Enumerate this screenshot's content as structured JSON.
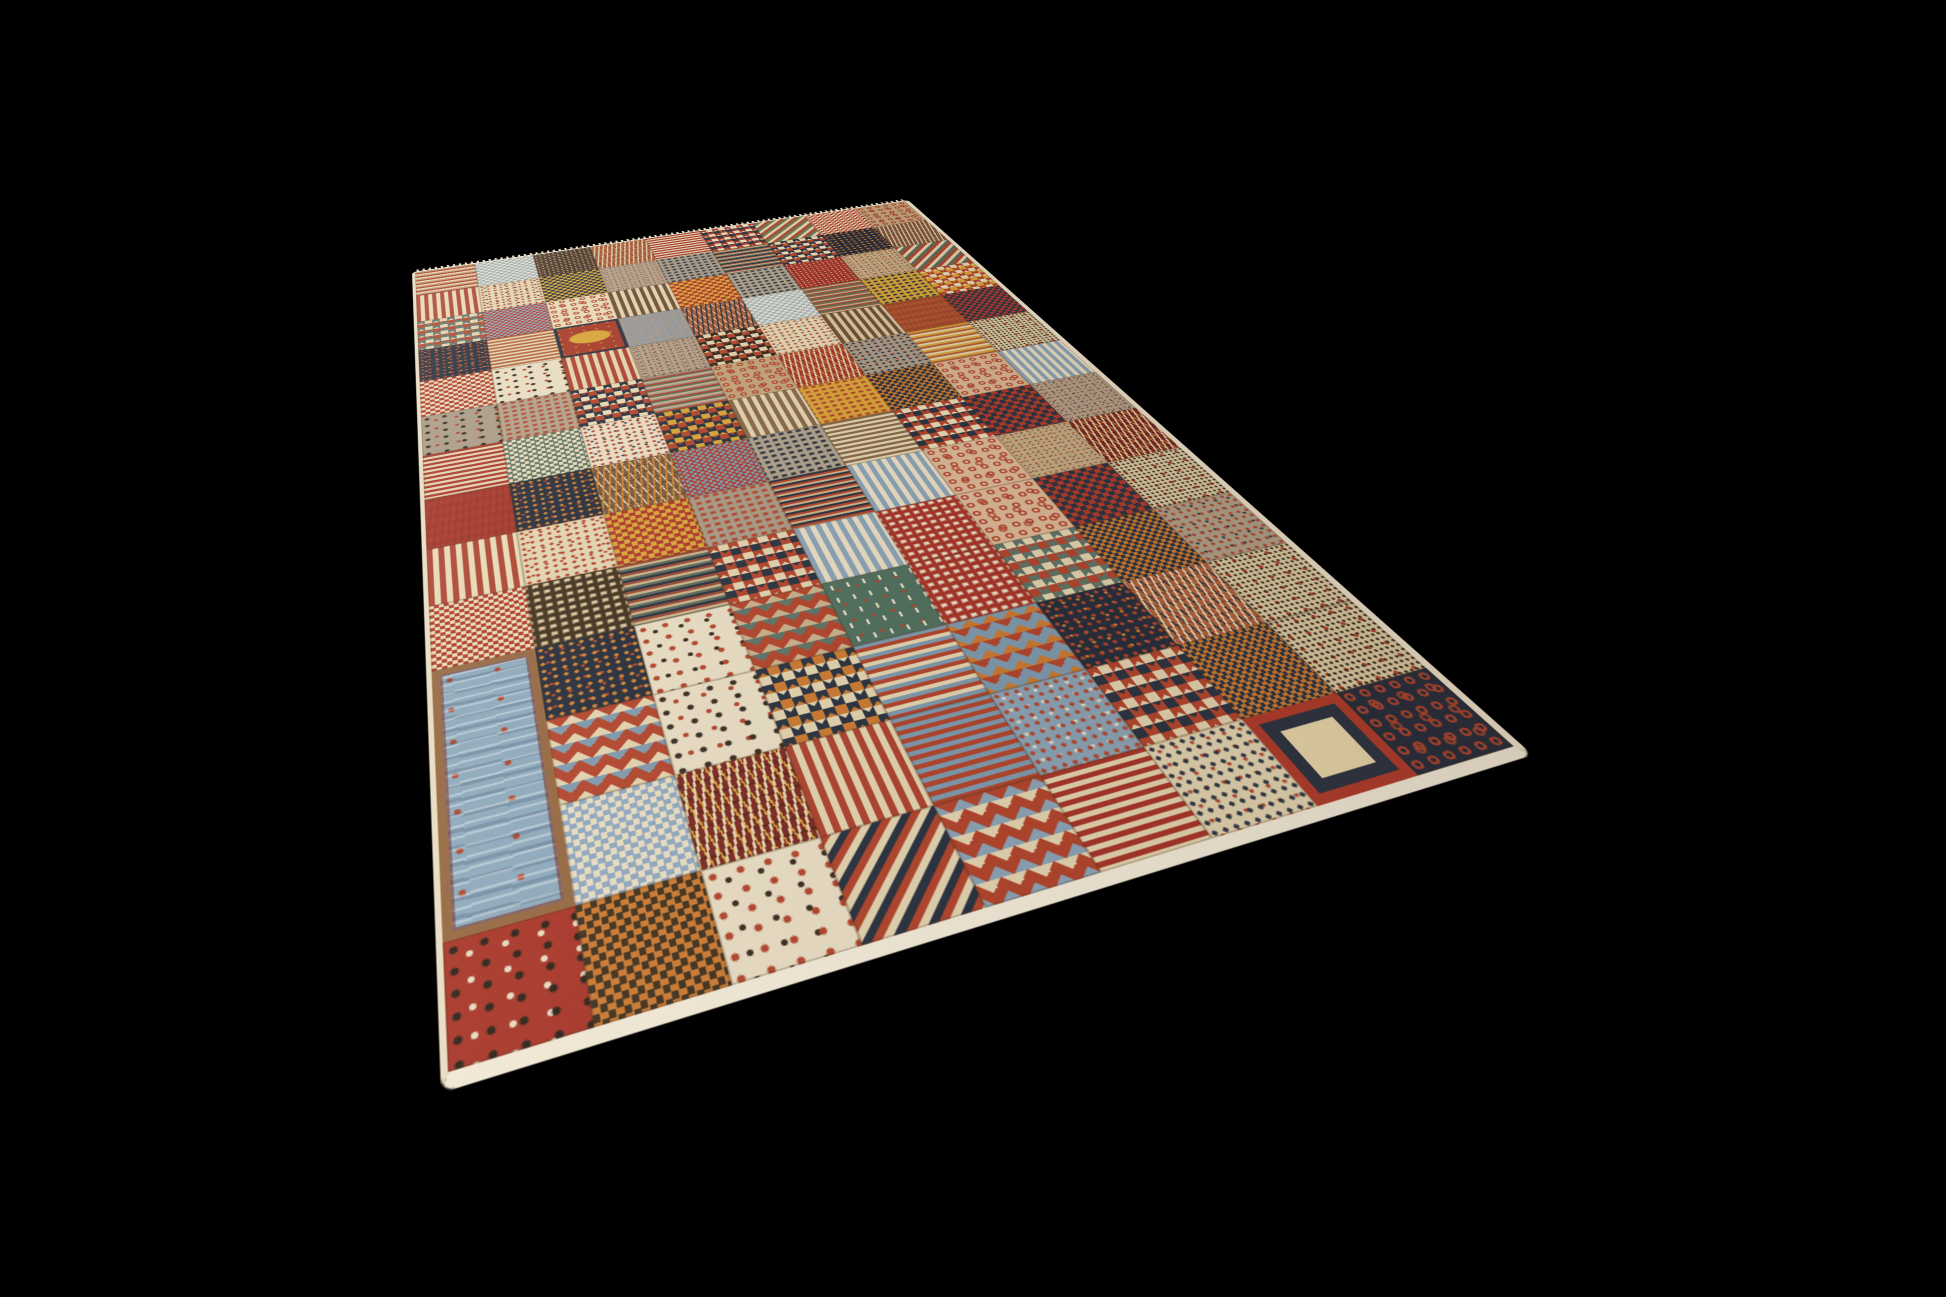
{
  "canvas": {
    "width": 1946,
    "height": 1297,
    "background_color": "#000000"
  },
  "rug": {
    "edge_color": "#e9ddc2",
    "near_edge_color": "#f1e8d5",
    "fringe_color": "#e6dcc4",
    "seam_color": "rgba(80,50,25,0.28)",
    "grid": {
      "cols": 9,
      "rows": 14
    },
    "palette": {
      "cream": "#e7d9b4",
      "sand": "#e3d2ad",
      "tan": "#c4a478",
      "taupe": "#b0a189",
      "red": "#b5452c",
      "deep_red": "#ab3528",
      "burgundy": "#7e2a22",
      "rust": "#b5603a",
      "orange": "#cd7a2f",
      "amber": "#d4842f",
      "gold": "#d9a435",
      "navy": "#2c3442",
      "ink": "#272e3c",
      "chocolate": "#43331f",
      "blue": "#8ba3b5",
      "sky": "#8ca9bd",
      "slate_blue": "#7e99ad",
      "teal": "#5f7468",
      "green": "#51705f",
      "olive": "#5d6b5a",
      "brown": "#7a5b42"
    },
    "patches": [
      {
        "p": "hstripes",
        "c": [
          "#c49a6c",
          "#a93b2b",
          "#e3d2ad"
        ]
      },
      {
        "p": "checker",
        "c": [
          "#93a9ba",
          "#e7dcc1"
        ],
        "s": 10
      },
      {
        "p": "speckle",
        "c": [
          "#4a392a",
          "#d8c49a",
          "#b5452c"
        ]
      },
      {
        "p": "herring",
        "c": [
          "#b5603a",
          "#e3d2ad",
          "#7a4a2e"
        ]
      },
      {
        "p": "hstripes",
        "c": [
          "#ab3528",
          "#e3d2ad"
        ]
      },
      {
        "p": "zigzag",
        "c": [
          "#e7d9b4",
          "#a93b2b",
          "#2c3442"
        ]
      },
      {
        "p": "dstripes",
        "c": [
          "#b04a2f",
          "#6b7a52",
          "#e3d2ad"
        ]
      },
      {
        "p": "checker",
        "c": [
          "#b23b2a",
          "#e7d9b4"
        ],
        "s": 8
      },
      {
        "p": "boteh",
        "c": [
          "#c4a478",
          "#a93b2b"
        ]
      },
      {
        "p": "vstripes",
        "c": [
          "#b04330",
          "#e7d9b4"
        ]
      },
      {
        "p": "dots",
        "c": [
          "#e2d3ae",
          "#b5452c",
          "#2c3442"
        ]
      },
      {
        "p": "checker",
        "c": [
          "#2c3442",
          "#d9a435"
        ],
        "s": 10
      },
      {
        "p": "speckle",
        "c": [
          "#b0a189",
          "#b5452c",
          "#5d6b5a"
        ]
      },
      {
        "p": "squares",
        "c": [
          "#a89a85",
          "#2c3442"
        ]
      },
      {
        "p": "hstripes",
        "c": [
          "#9e4a33",
          "#c9b089",
          "#5d6b5a",
          "#2c3442"
        ],
        "s": 3
      },
      {
        "p": "zigzag",
        "c": [
          "#e7d9b4",
          "#2c3442",
          "#b5452c"
        ]
      },
      {
        "p": "dots",
        "c": [
          "#272e3c",
          "#d4842f",
          "#b5452c"
        ]
      },
      {
        "p": "herring",
        "c": [
          "#7a5b42",
          "#e3d2ad",
          "#b5452c"
        ]
      },
      {
        "p": "zigzag",
        "c": [
          "#e3d2ad",
          "#5f7468",
          "#b5452c"
        ]
      },
      {
        "p": "checker",
        "c": [
          "#8fa8bf",
          "#b23b2a"
        ],
        "s": 8
      },
      {
        "p": "boteh",
        "c": [
          "#e7d9b4",
          "#b5452c"
        ]
      },
      {
        "p": "vstripes",
        "c": [
          "#6f5137",
          "#e3d2ad"
        ]
      },
      {
        "p": "checker",
        "c": [
          "#d9a435",
          "#b23b2a"
        ],
        "s": 12
      },
      {
        "p": "squares",
        "c": [
          "#b0a189",
          "#2c3442"
        ]
      },
      {
        "p": "speckle",
        "c": [
          "#ab3528",
          "#e3d2ad",
          "#2c3442"
        ]
      },
      {
        "p": "speckle",
        "c": [
          "#c4ac82",
          "#b5452c",
          "#2c3442"
        ]
      },
      {
        "p": "dstripes",
        "c": [
          "#b5452c",
          "#e3d2ad",
          "#5d6b5a"
        ]
      },
      {
        "p": "dots",
        "c": [
          "#272e3c",
          "#b5452c",
          "#d4842f"
        ]
      },
      {
        "p": "hstripes",
        "c": [
          "#b5603a",
          "#e3d2ad"
        ]
      },
      {
        "p": "emblem",
        "c": [
          "#a93b2b",
          "#d9a435",
          "#2c3442"
        ]
      },
      {
        "p": "squares",
        "c": [
          "#a3988a",
          "#7e99ad"
        ]
      },
      {
        "p": "herring",
        "c": [
          "#b5603a",
          "#2c3442",
          "#e3d2ad"
        ]
      },
      {
        "p": "checker",
        "c": [
          "#9db3c2",
          "#e7dcc1"
        ],
        "s": 10
      },
      {
        "p": "hstripes",
        "c": [
          "#8a6a4a",
          "#c9b089",
          "#b5452c",
          "#5d6b5a"
        ],
        "s": 3
      },
      {
        "p": "squares",
        "c": [
          "#d9a435",
          "#2c3442"
        ]
      },
      {
        "p": "zigzag",
        "c": [
          "#e7d9b4",
          "#b5452c",
          "#d9a435"
        ]
      },
      {
        "p": "checker",
        "c": [
          "#b23b2a",
          "#e7d9b4"
        ],
        "s": 10
      },
      {
        "p": "animals",
        "c": [
          "#e7dcc1",
          "#3a2d20",
          "#b5452c"
        ]
      },
      {
        "p": "vstripes",
        "c": [
          "#b04330",
          "#e3d2ad"
        ]
      },
      {
        "p": "speckle",
        "c": [
          "#b0a189",
          "#b5452c",
          "#2c3442"
        ]
      },
      {
        "p": "zigzag",
        "c": [
          "#e3d2ad",
          "#33291e",
          "#b5452c"
        ]
      },
      {
        "p": "dots",
        "c": [
          "#e2d3ae",
          "#b5452c",
          "#7e99ad"
        ]
      },
      {
        "p": "vstripes",
        "c": [
          "#6f5137",
          "#d8c49a"
        ]
      },
      {
        "p": "plain",
        "c": [
          "#b4552f",
          "#8e2a1f"
        ]
      },
      {
        "p": "checker",
        "c": [
          "#2c3442",
          "#b23b2a"
        ],
        "s": 10
      },
      {
        "p": "animals",
        "c": [
          "#a89a85",
          "#3a2d20",
          "#b5452c"
        ]
      },
      {
        "p": "squares",
        "c": [
          "#b0a189",
          "#b5452c"
        ]
      },
      {
        "p": "zigzag",
        "c": [
          "#e7d9b4",
          "#2c3442",
          "#b5452c"
        ]
      },
      {
        "p": "hstripes",
        "c": [
          "#a3988a",
          "#b5452c",
          "#5d6b5a",
          "#c9b089"
        ],
        "s": 3
      },
      {
        "p": "boteh",
        "c": [
          "#c4a478",
          "#b5452c"
        ]
      },
      {
        "p": "herring",
        "c": [
          "#a93b2b",
          "#e3d2ad",
          "#d4842f"
        ]
      },
      {
        "p": "dots",
        "c": [
          "#a89a85",
          "#2c3442",
          "#b5452c"
        ]
      },
      {
        "p": "hstripes",
        "c": [
          "#d9a435",
          "#b5603a",
          "#e3d2ad"
        ]
      },
      {
        "p": "speckletree",
        "c": [
          "#ddcba2",
          "#3a2d20",
          "#b5452c"
        ]
      },
      {
        "p": "hstripes",
        "c": [
          "#ab3528",
          "#e3d2ad"
        ]
      },
      {
        "p": "checker",
        "c": [
          "#5f7468",
          "#e7d9b4"
        ],
        "s": 9
      },
      {
        "p": "dots",
        "c": [
          "#e7dcc1",
          "#b5452c",
          "#2c3442"
        ]
      },
      {
        "p": "zigzag",
        "c": [
          "#d9a435",
          "#2c3442",
          "#b5452c"
        ]
      },
      {
        "p": "vstripes",
        "c": [
          "#8a6a4a",
          "#e3d2ad"
        ]
      },
      {
        "p": "squares",
        "c": [
          "#d9a435",
          "#b5452c"
        ]
      },
      {
        "p": "checker",
        "c": [
          "#cd7a2f",
          "#2c3442"
        ],
        "s": 9
      },
      {
        "p": "boteh",
        "c": [
          "#d9b48f",
          "#b5452c"
        ]
      },
      {
        "p": "vstripes",
        "c": [
          "#8ba3b5",
          "#e7dcc1"
        ]
      },
      {
        "p": "plain",
        "c": [
          "#ab3528",
          "#8e2a1f"
        ]
      },
      {
        "p": "dots",
        "c": [
          "#272e3c",
          "#d4842f",
          "#b5452c"
        ]
      },
      {
        "p": "herring",
        "c": [
          "#7a5b42",
          "#d4842f",
          "#e3d2ad"
        ]
      },
      {
        "p": "checker",
        "c": [
          "#b23b2a",
          "#7e99ad"
        ],
        "s": 7
      },
      {
        "p": "squares",
        "c": [
          "#b0a189",
          "#2c3442"
        ]
      },
      {
        "p": "hstripes",
        "c": [
          "#8a6a4a",
          "#e3d2ad"
        ]
      },
      {
        "p": "zigzag",
        "c": [
          "#e7d9b4",
          "#b5452c",
          "#2c3442"
        ]
      },
      {
        "p": "checker",
        "c": [
          "#b23b2a",
          "#2c3442"
        ],
        "s": 13
      },
      {
        "p": "speckle",
        "c": [
          "#b0a189",
          "#b5452c",
          "#2c3442"
        ]
      },
      {
        "p": "vstripes",
        "c": [
          "#b04330",
          "#e7d9b4"
        ]
      },
      {
        "p": "dots",
        "c": [
          "#e2d3ae",
          "#b5452c",
          "#b5452c"
        ]
      },
      {
        "p": "checker",
        "c": [
          "#b23b2a",
          "#d9a435"
        ],
        "s": 11
      },
      {
        "p": "squares",
        "c": [
          "#a89a85",
          "#b5452c"
        ]
      },
      {
        "p": "hstripes",
        "c": [
          "#2c3442",
          "#b5452c",
          "#c9b089"
        ],
        "s": 3
      },
      {
        "p": "vstripes",
        "c": [
          "#8ba3b5",
          "#e7dcc1"
        ]
      },
      {
        "p": "boteh",
        "c": [
          "#dcb896",
          "#b5452c"
        ]
      },
      {
        "p": "speckle",
        "c": [
          "#c4ac82",
          "#b5452c",
          "#5d6b5a"
        ]
      },
      {
        "p": "herring",
        "c": [
          "#7e2a22",
          "#e3d2ad",
          "#d4842f"
        ]
      },
      {
        "p": "checker",
        "c": [
          "#b23b2a",
          "#e7d9b4"
        ],
        "s": 8
      },
      {
        "p": "squares",
        "c": [
          "#43331f",
          "#d8c49a"
        ]
      },
      {
        "p": "hstripes",
        "c": [
          "#9e4a33",
          "#c9b089",
          "#5d6b5a",
          "#2c3442"
        ],
        "s": 3
      },
      {
        "p": "zigzag",
        "c": [
          "#e3d2ad",
          "#b5452c",
          "#2c3442"
        ]
      },
      {
        "p": "vstripes",
        "c": [
          "#8ba3b5",
          "#e7dcc1"
        ]
      },
      {
        "p": "squares",
        "c": [
          "#ab3528",
          "#e7dcc1"
        ]
      },
      {
        "p": "boteh",
        "c": [
          "#dcb896",
          "#b5452c"
        ]
      },
      {
        "p": "checker",
        "c": [
          "#b23b2a",
          "#2c3442"
        ],
        "s": 12
      },
      {
        "p": "speckletree",
        "c": [
          "#ddcba2",
          "#3a2d20",
          "#b5452c"
        ]
      },
      {
        "p": "bluepanel",
        "c": [
          "#8ca9bd",
          "#b5452c",
          "#96683f"
        ],
        "rs": 3
      },
      {
        "p": "dots",
        "c": [
          "#272e3c",
          "#d4842f",
          "#b5452c"
        ]
      },
      {
        "p": "animals",
        "c": [
          "#e7dcc1",
          "#b5452c",
          "#3a2d20"
        ]
      },
      {
        "p": "harlequin",
        "c": [
          "#c9b089",
          "#b5452c",
          "#5f7468"
        ]
      },
      {
        "p": "sprouts",
        "c": [
          "#51705f",
          "#e7dcc1",
          "#b5452c"
        ]
      },
      {
        "p": "squares",
        "c": [
          "#ab3528",
          "#e7dcc1"
        ]
      },
      {
        "p": "zigzag",
        "c": [
          "#e3d2ad",
          "#5f7468",
          "#b5452c"
        ]
      },
      {
        "p": "checker",
        "c": [
          "#cd7a2f",
          "#2c3442"
        ],
        "s": 8
      },
      {
        "p": "dots",
        "c": [
          "#b0a189",
          "#b5452c",
          "#2c3442"
        ]
      },
      {
        "p": "harlequin",
        "c": [
          "#e3d2ad",
          "#b5452c",
          "#7e99ad"
        ]
      },
      {
        "p": "animals",
        "c": [
          "#e7dcc1",
          "#3a2d20",
          "#b5452c"
        ]
      },
      {
        "p": "zigzag",
        "c": [
          "#cd7a2f",
          "#2c3442",
          "#e3d2ad"
        ]
      },
      {
        "p": "hstripes",
        "c": [
          "#7e99ad",
          "#b5452c",
          "#e3d2ad"
        ]
      },
      {
        "p": "harlequin",
        "c": [
          "#cd7a2f",
          "#7e99ad",
          "#b5452c"
        ]
      },
      {
        "p": "dots",
        "c": [
          "#272e3c",
          "#b5452c",
          "#d4842f"
        ]
      },
      {
        "p": "herring",
        "c": [
          "#b5603a",
          "#e3d2ad",
          "#2c3442"
        ]
      },
      {
        "p": "speckletree",
        "c": [
          "#ddcba2",
          "#3a2d20",
          "#b5452c"
        ]
      },
      {
        "p": "checker",
        "c": [
          "#8fa8bf",
          "#e7dcc1"
        ],
        "s": 9
      },
      {
        "p": "herring",
        "c": [
          "#7e2a22",
          "#e3d2ad",
          "#d9a435"
        ]
      },
      {
        "p": "vstripes",
        "c": [
          "#b04330",
          "#e3d2ad"
        ]
      },
      {
        "p": "hstripes",
        "c": [
          "#7e99ad",
          "#b5452c"
        ]
      },
      {
        "p": "dots",
        "c": [
          "#8ba3b5",
          "#b5452c",
          "#e7dcc1"
        ]
      },
      {
        "p": "zigzag",
        "c": [
          "#e3d2ad",
          "#b5452c",
          "#2c3442"
        ]
      },
      {
        "p": "checker",
        "c": [
          "#cd7a2f",
          "#2c3442"
        ],
        "s": 7
      },
      {
        "p": "speckletree",
        "c": [
          "#ddcba2",
          "#3a2d20",
          "#b5452c"
        ]
      },
      {
        "p": "animals",
        "c": [
          "#ab3528",
          "#2e2318",
          "#e7dcc1"
        ]
      },
      {
        "p": "checker",
        "c": [
          "#cd7a2f",
          "#43331f"
        ],
        "s": 9
      },
      {
        "p": "animals",
        "c": [
          "#e7dcc1",
          "#b5452c",
          "#3a2d20"
        ]
      },
      {
        "p": "dstripes",
        "c": [
          "#b5452c",
          "#e3d2ad",
          "#2c3442"
        ]
      },
      {
        "p": "harlequin",
        "c": [
          "#8ba3b5",
          "#b5452c",
          "#e3d2ad"
        ]
      },
      {
        "p": "hstripes",
        "c": [
          "#ab3528",
          "#e3d2ad"
        ]
      },
      {
        "p": "dots",
        "c": [
          "#e2d3ae",
          "#2c3442",
          "#b5452c"
        ]
      },
      {
        "p": "signature",
        "c": [
          "#e9d6a8",
          "#2c3442",
          "#b23b2a"
        ]
      },
      {
        "p": "boteh",
        "c": [
          "#272e3c",
          "#b5452c"
        ]
      }
    ]
  }
}
